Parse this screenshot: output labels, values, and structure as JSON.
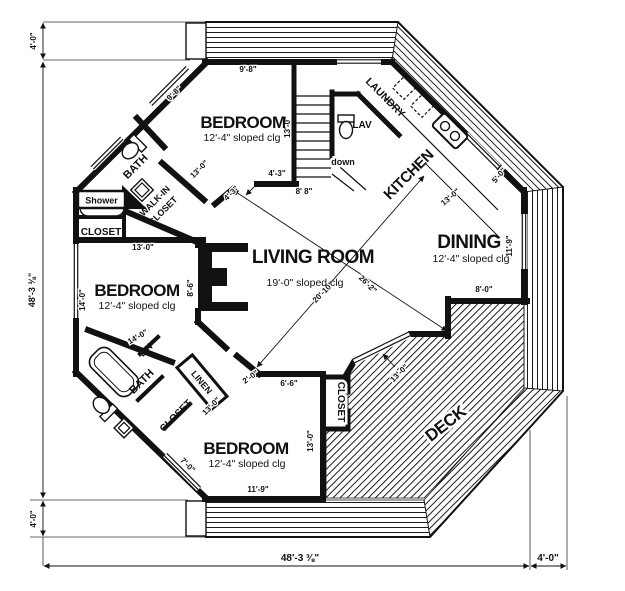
{
  "colors": {
    "ink": "#111111",
    "paper": "#ffffff"
  },
  "rooms": {
    "bedroom_top": {
      "label": "BEDROOM",
      "sub": "12'-4\" sloped clg"
    },
    "bedroom_left": {
      "label": "BEDROOM",
      "sub": "12'-4\" sloped clg"
    },
    "bedroom_bottom": {
      "label": "BEDROOM",
      "sub": "12'-4\" sloped clg"
    },
    "living": {
      "label": "LIVING ROOM",
      "sub": "19'-0\" sloped clg"
    },
    "dining": {
      "label": "DINING",
      "sub": "12'-4\" sloped clg"
    },
    "kitchen": {
      "label": "KITCHEN"
    },
    "laundry": {
      "label": "LAUNDRY"
    },
    "lav": {
      "label": "LAV"
    },
    "bath_top": {
      "label": "BATH"
    },
    "bath_bottom": {
      "label": "BATH"
    },
    "deck": {
      "label": "DECK"
    }
  },
  "closets": {
    "shower": "Shower",
    "closet_top": "CLOSET",
    "walk_in_line1": "WALK-IN",
    "walk_in_line2": "CLOSET",
    "lin": "LIN",
    "linen": "LINEN",
    "closet_bottom_left": "CLOSET",
    "closet_bottom_right": "CLOSET"
  },
  "stairs": {
    "down_label": "down"
  },
  "dims": {
    "deck_top": "4'-0\"",
    "overall_left": "48'-3 ⅜\"",
    "deck_bottom_left": "4'-0\"",
    "overall_bottom": "48'-3 ⅜\"",
    "deck_bottom_right": "4'-0\"",
    "n_wall": "9'-8\"",
    "nw_wall": "9'-8\"",
    "stairs_side": "13'-0\"",
    "hall_a": "4'-3\"",
    "hall_b": "4'-3\"",
    "hall_width": "8' 8\"",
    "walkin_wall": "13'-0\"",
    "bedroom_left_top": "13'-0\"",
    "w_wall": "14'-0\"",
    "living_left": "8'-6\"",
    "living_diag_a": "20'-10\"",
    "living_diag_b": "26'-2\"",
    "kitchen_window": "5'-0\"",
    "kitchen_depth": "13'-0\"",
    "dining_right": "11'-9\"",
    "dining_bottom": "8'-0\"",
    "entry_a": "2'-0\"",
    "entry_b": "6'-6\"",
    "bath_wall": "14'-0\"",
    "linen_wall": "13'-0\"",
    "deck_door": "13'-0\"",
    "bedroom_bottom_right": "13'-0\"",
    "bedroom_bottom_wall": "11'-9\"",
    "sw_window": "7'-0\""
  }
}
